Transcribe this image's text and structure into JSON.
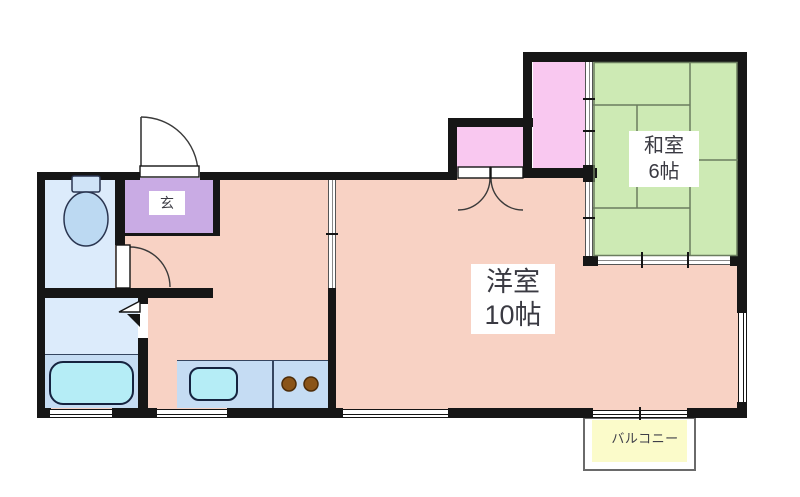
{
  "floorplan": {
    "rooms": {
      "western": {
        "name": "洋室",
        "size": "10帖"
      },
      "japanese": {
        "name": "和室",
        "size": "6帖"
      },
      "entrance": {
        "name": "玄"
      },
      "balcony": {
        "name": "バルコニー"
      }
    },
    "fixtures": [
      "toilet",
      "bathtub",
      "kitchen-sink",
      "two-burner-stove"
    ],
    "features": [
      "entrance-swing-door",
      "toilet-swing-door",
      "folding-door",
      "closet-double-doors",
      "sliding-doors",
      "windows"
    ],
    "colors": {
      "wall": "#161616",
      "room_salmon": "#f8d2c4",
      "tatami_green": "#cdeab4",
      "closet_pink": "#f9c8f0",
      "entrance_purple": "#c9abe4",
      "waterroom_blue": "#dcebfb",
      "counter_blue": "#c5dcf3",
      "fixture_cyan": "#b5edf6",
      "balcony_yellow": "#fbfbca",
      "burner_brown": "#8a5418"
    }
  }
}
